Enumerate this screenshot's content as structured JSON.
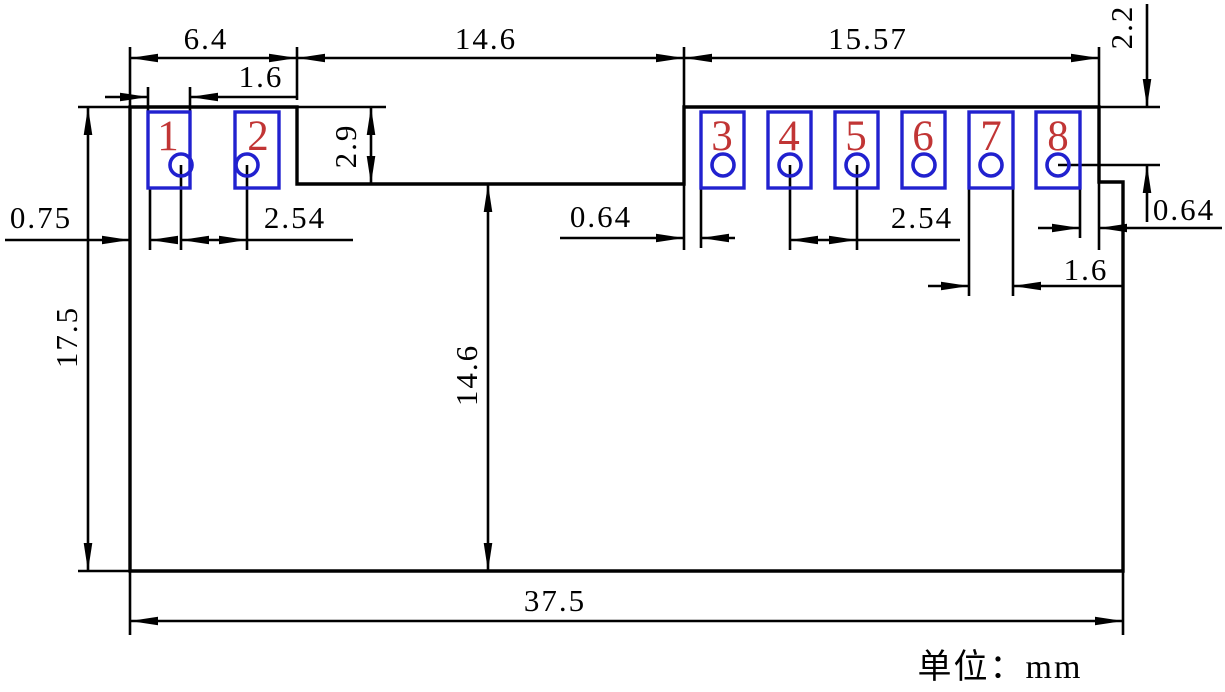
{
  "drawing": {
    "type": "pcb-module-dimension-drawing",
    "unit_label": "单位：mm"
  },
  "colors": {
    "line": "#000000",
    "pad": "#2121cf",
    "pin_number": "#c13535",
    "background": "#ffffff"
  },
  "pins": [
    "1",
    "2",
    "3",
    "4",
    "5",
    "6",
    "7",
    "8"
  ],
  "dimensions": {
    "left_section_width": "6.4",
    "notch_width": "14.6",
    "right_section_width": "15.57",
    "pad1_width": "1.6",
    "notch_depth": "2.9",
    "left_edge_to_pad1": "0.75",
    "left_hole_pitch": "2.54",
    "notch_to_pad3": "0.64",
    "right_hole_pitch": "2.54",
    "pad7_width": "1.6",
    "pad8_to_right_edge": "0.64",
    "top_edge_to_hole_center": "2.2",
    "body_height": "17.5",
    "lower_section_height": "14.6",
    "total_width": "37.5"
  }
}
